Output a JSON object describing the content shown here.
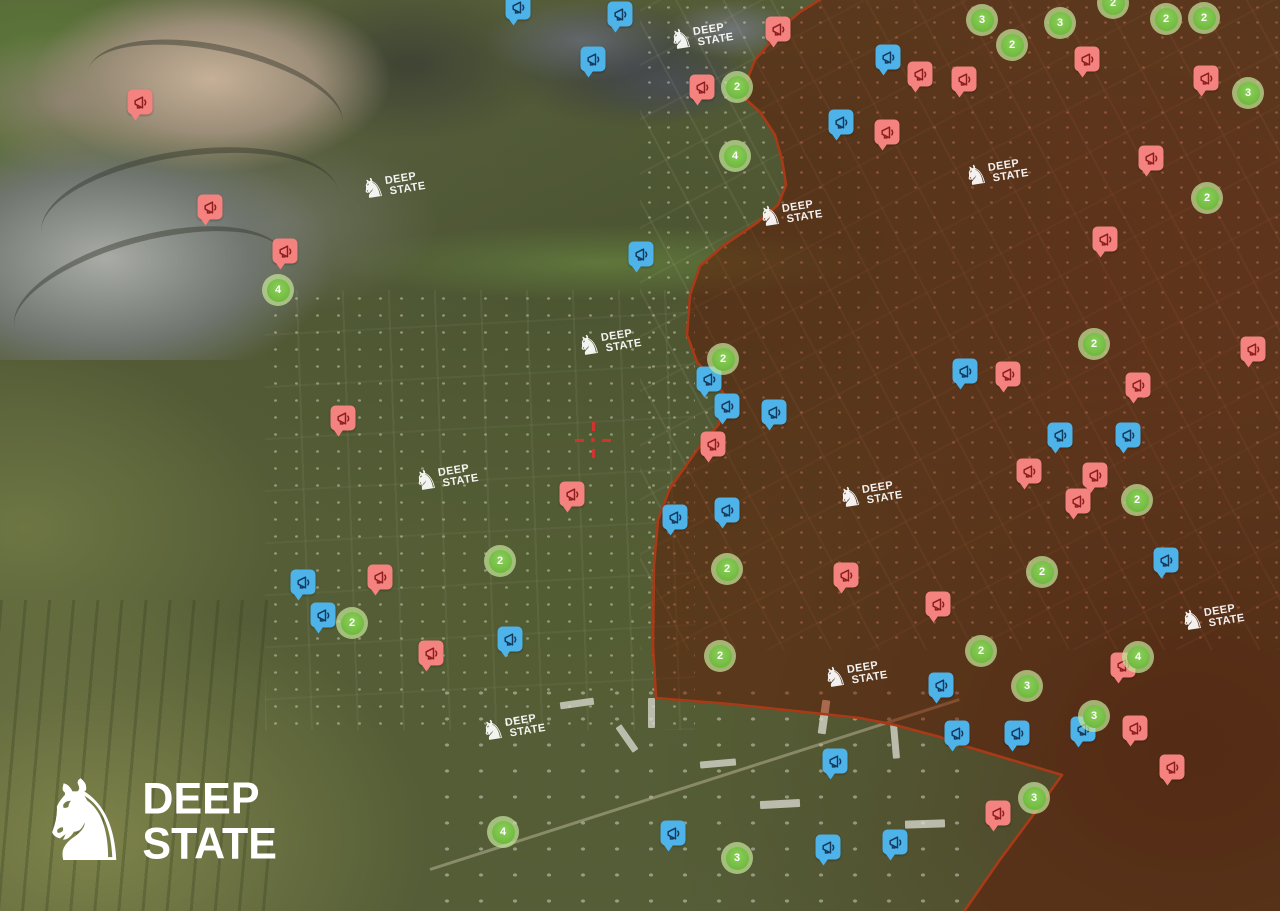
{
  "logo": {
    "text_line1": "DEEP",
    "text_line2": "STATE",
    "knight_glyph": "♞"
  },
  "watermark": {
    "text_line1": "DEEP",
    "text_line2": "STATE",
    "knight_glyph": "♞"
  },
  "colors": {
    "occupied_fill": "#c0512a",
    "frontline": "#a93a17",
    "report_marker_pink": "#f4827e",
    "report_marker_pink_icon": "#8b1e1e",
    "report_marker_blue": "#4eb3e8",
    "report_marker_blue_icon": "#14395c",
    "cluster_green": "#6fb93e",
    "cluster_ring": "rgba(196,229,152,0.72)",
    "crosshair_red": "#d0342c"
  },
  "map": {
    "crosshair": {
      "x": 593,
      "y": 440
    },
    "frontline_line_points": "823,-2 800,12 787,23 755,60 741,95 760,112 775,135 782,160 786,185 778,205 758,222 723,246 700,266 690,295 687,335 697,362 715,382 724,394 719,424 697,450 670,488 658,520 654,565 653,645 656,698 730,704 860,718 895,725 940,737 958,744 1062,775 1031,818 999,861 963,913",
    "frontline_fill_points": "823,-2 1282,-2 1282,913 963,913 999,861 1031,818 1062,775 958,744 940,737 895,725 860,718 730,704 656,698 653,645 654,565 658,520 670,488 697,450 719,424 724,394 715,382 697,362 687,335 690,295 700,266 723,246 758,222 778,205 786,185 782,160 775,135 760,112 741,95 755,60 787,23 800,12",
    "pink_markers": [
      [
        140,
        105
      ],
      [
        210,
        210
      ],
      [
        285,
        254
      ],
      [
        343,
        421
      ],
      [
        572,
        497
      ],
      [
        380,
        580
      ],
      [
        431,
        656
      ],
      [
        702,
        90
      ],
      [
        778,
        32
      ],
      [
        920,
        77
      ],
      [
        964,
        82
      ],
      [
        887,
        135
      ],
      [
        1087,
        62
      ],
      [
        1206,
        81
      ],
      [
        1151,
        161
      ],
      [
        1105,
        242
      ],
      [
        713,
        447
      ],
      [
        846,
        578
      ],
      [
        938,
        607
      ],
      [
        1008,
        377
      ],
      [
        1253,
        352
      ],
      [
        1138,
        388
      ],
      [
        1029,
        474
      ],
      [
        1095,
        478
      ],
      [
        1078,
        504
      ],
      [
        1123,
        668
      ],
      [
        1135,
        731
      ],
      [
        1172,
        770
      ],
      [
        998,
        816
      ]
    ],
    "blue_markers": [
      [
        518,
        10
      ],
      [
        620,
        17
      ],
      [
        593,
        62
      ],
      [
        641,
        257
      ],
      [
        303,
        585
      ],
      [
        323,
        618
      ],
      [
        510,
        642
      ],
      [
        709,
        382
      ],
      [
        727,
        409
      ],
      [
        774,
        415
      ],
      [
        675,
        520
      ],
      [
        727,
        513
      ],
      [
        888,
        60
      ],
      [
        841,
        125
      ],
      [
        965,
        374
      ],
      [
        1060,
        438
      ],
      [
        1128,
        438
      ],
      [
        1166,
        563
      ],
      [
        941,
        688
      ],
      [
        957,
        736
      ],
      [
        1017,
        736
      ],
      [
        1083,
        732
      ],
      [
        835,
        764
      ],
      [
        673,
        836
      ],
      [
        828,
        850
      ],
      [
        895,
        845
      ]
    ],
    "clusters": [
      {
        "x": 278,
        "y": 290,
        "count": "4"
      },
      {
        "x": 737,
        "y": 87,
        "count": "2"
      },
      {
        "x": 735,
        "y": 156,
        "count": "4"
      },
      {
        "x": 723,
        "y": 359,
        "count": "2"
      },
      {
        "x": 500,
        "y": 561,
        "count": "2"
      },
      {
        "x": 352,
        "y": 623,
        "count": "2"
      },
      {
        "x": 503,
        "y": 832,
        "count": "4"
      },
      {
        "x": 737,
        "y": 858,
        "count": "3"
      },
      {
        "x": 727,
        "y": 569,
        "count": "2"
      },
      {
        "x": 720,
        "y": 656,
        "count": "2"
      },
      {
        "x": 982,
        "y": 20,
        "count": "3"
      },
      {
        "x": 1060,
        "y": 23,
        "count": "3"
      },
      {
        "x": 1113,
        "y": 3,
        "count": "2"
      },
      {
        "x": 1166,
        "y": 19,
        "count": "2"
      },
      {
        "x": 1204,
        "y": 18,
        "count": "2"
      },
      {
        "x": 1012,
        "y": 45,
        "count": "2"
      },
      {
        "x": 1248,
        "y": 93,
        "count": "3"
      },
      {
        "x": 1207,
        "y": 198,
        "count": "2"
      },
      {
        "x": 1094,
        "y": 344,
        "count": "2"
      },
      {
        "x": 1137,
        "y": 500,
        "count": "2"
      },
      {
        "x": 1042,
        "y": 572,
        "count": "2"
      },
      {
        "x": 981,
        "y": 651,
        "count": "2"
      },
      {
        "x": 1138,
        "y": 657,
        "count": "4"
      },
      {
        "x": 1027,
        "y": 686,
        "count": "3"
      },
      {
        "x": 1094,
        "y": 716,
        "count": "3"
      },
      {
        "x": 1034,
        "y": 798,
        "count": "3"
      }
    ],
    "watermarks": [
      [
        701,
        37
      ],
      [
        996,
        173
      ],
      [
        393,
        186
      ],
      [
        790,
        214
      ],
      [
        609,
        343
      ],
      [
        446,
        478
      ],
      [
        870,
        495
      ],
      [
        1212,
        618
      ],
      [
        855,
        675
      ],
      [
        513,
        728
      ]
    ]
  }
}
